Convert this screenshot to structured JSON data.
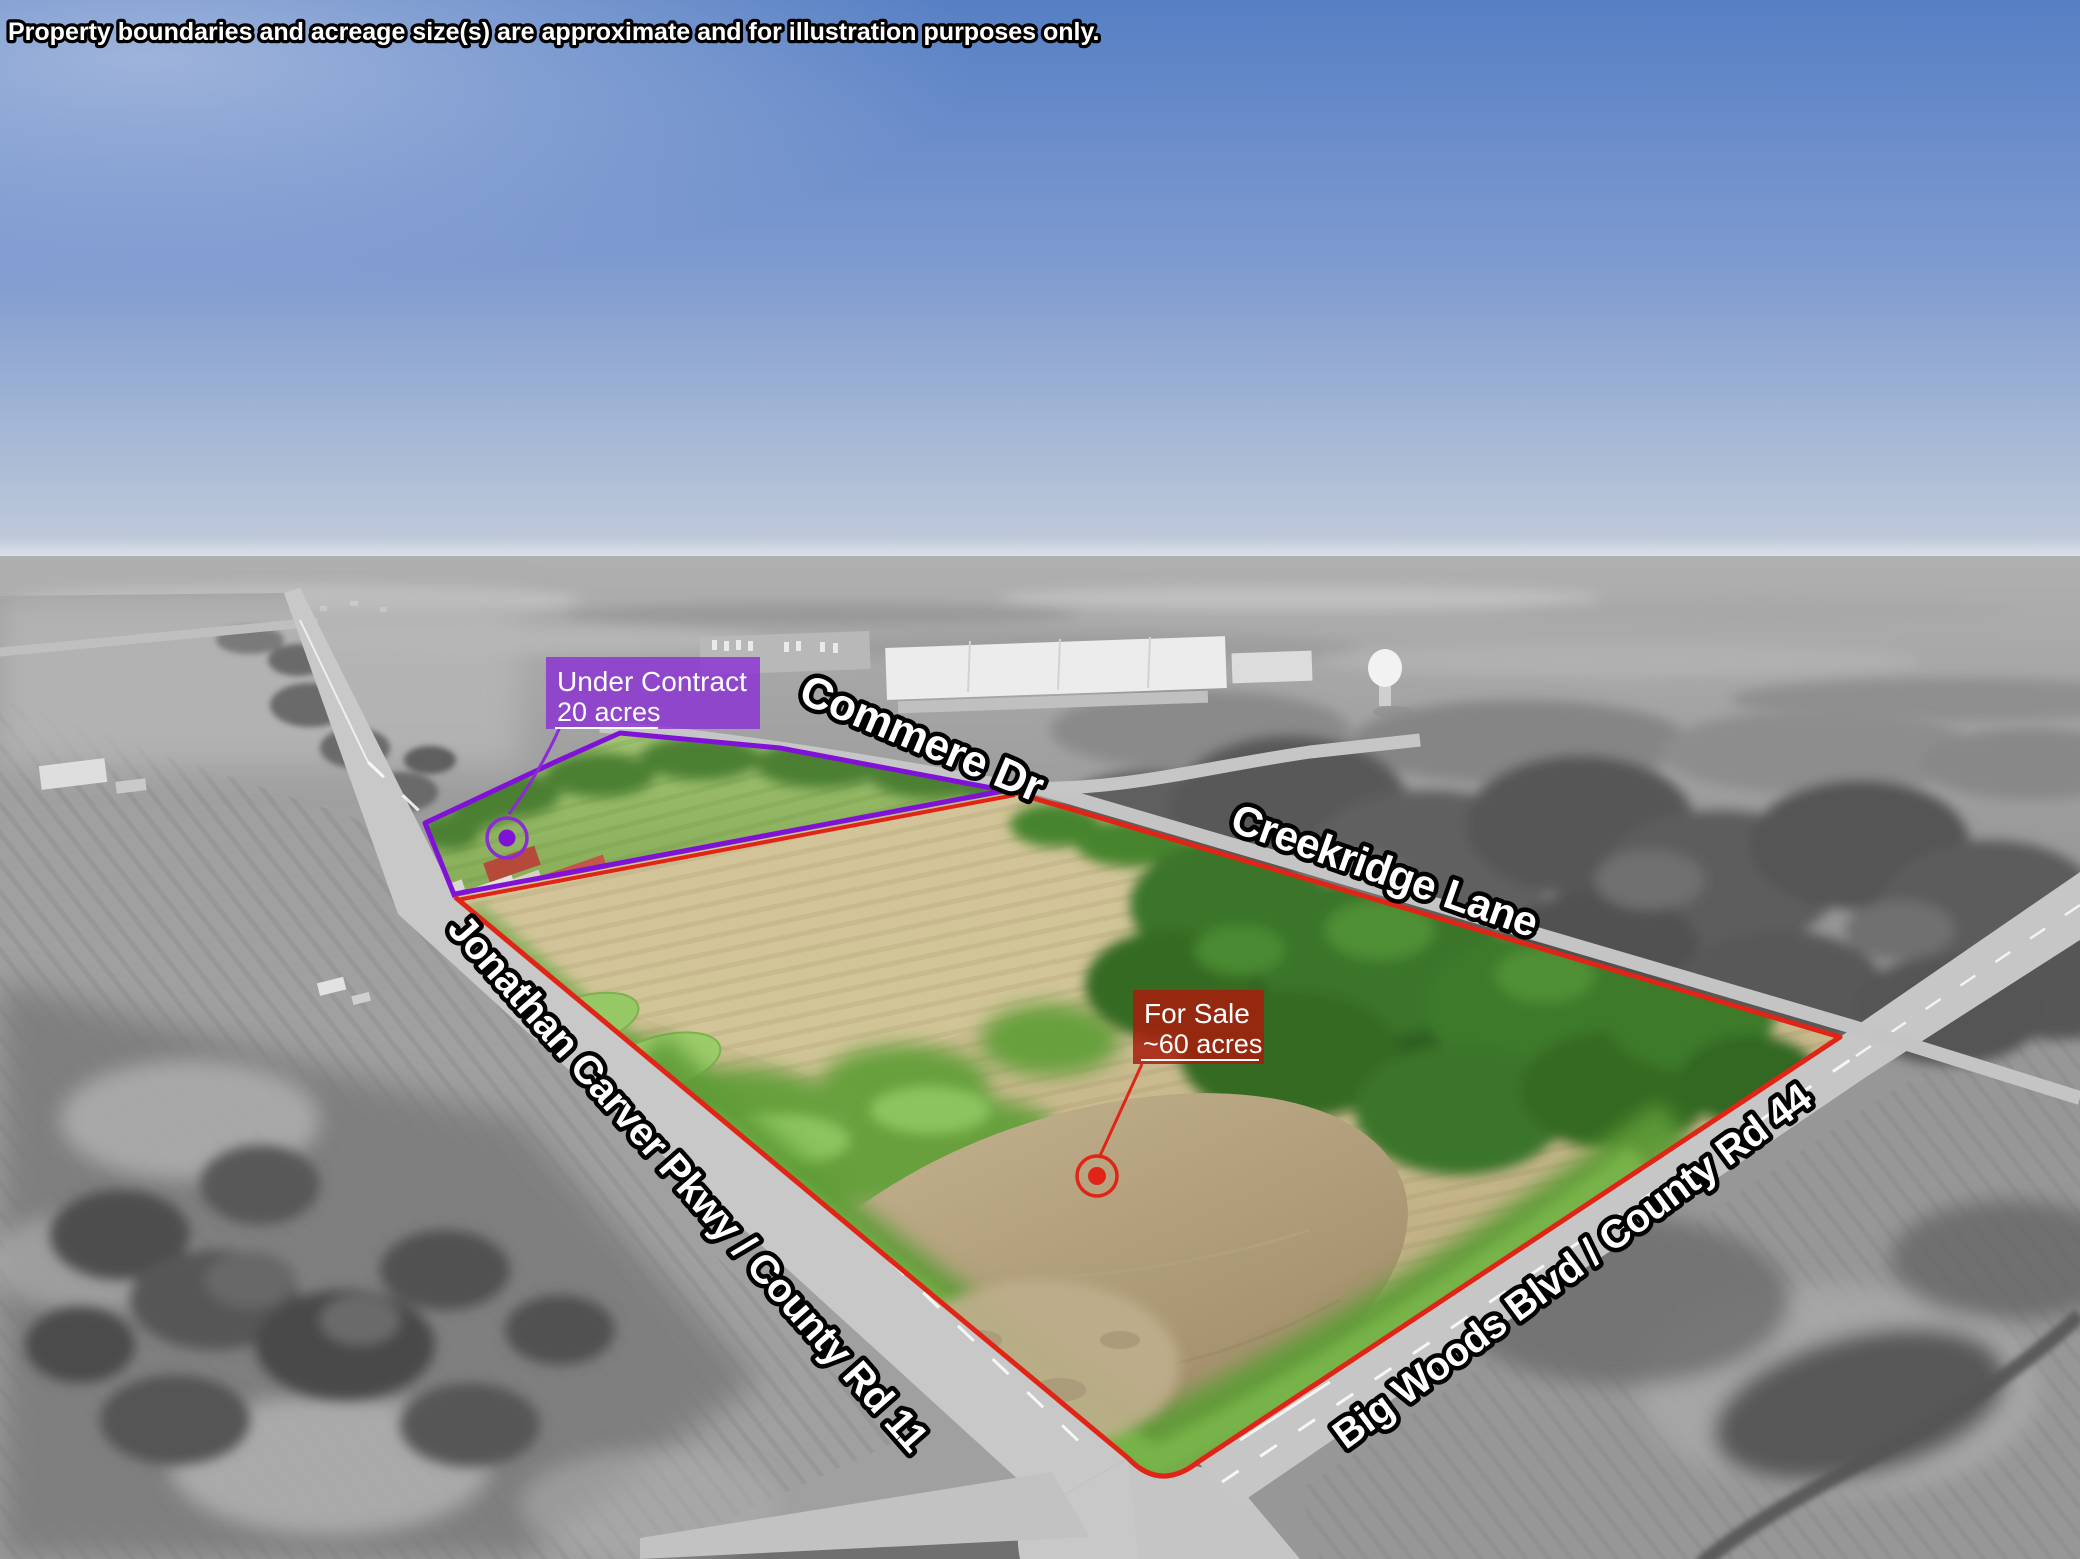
{
  "disclaimer": "Property boundaries and acreage size(s) are approximate and for illustration purposes only.",
  "parcel_labels": {
    "under_contract": {
      "title": "Under Contract",
      "acreage": "20 acres"
    },
    "for_sale": {
      "title": "For Sale",
      "acreage": "~60 acres"
    }
  },
  "road_labels": {
    "commere_dr": "Commere Dr",
    "creekridge_lane": "Creekridge Lane",
    "jonathan_carver_pkwy": "Jonathan Carver Pkwy / County Rd 11",
    "big_woods_blvd": "Big Woods Blvd / County Rd 44"
  },
  "colors": {
    "for_sale_accent": "#e02517",
    "for_sale_box_fill": "#a81c0c",
    "under_contract_accent": "#8012d8",
    "under_contract_box_fill": "#8a2bd6",
    "label_text": "#ffffff"
  }
}
